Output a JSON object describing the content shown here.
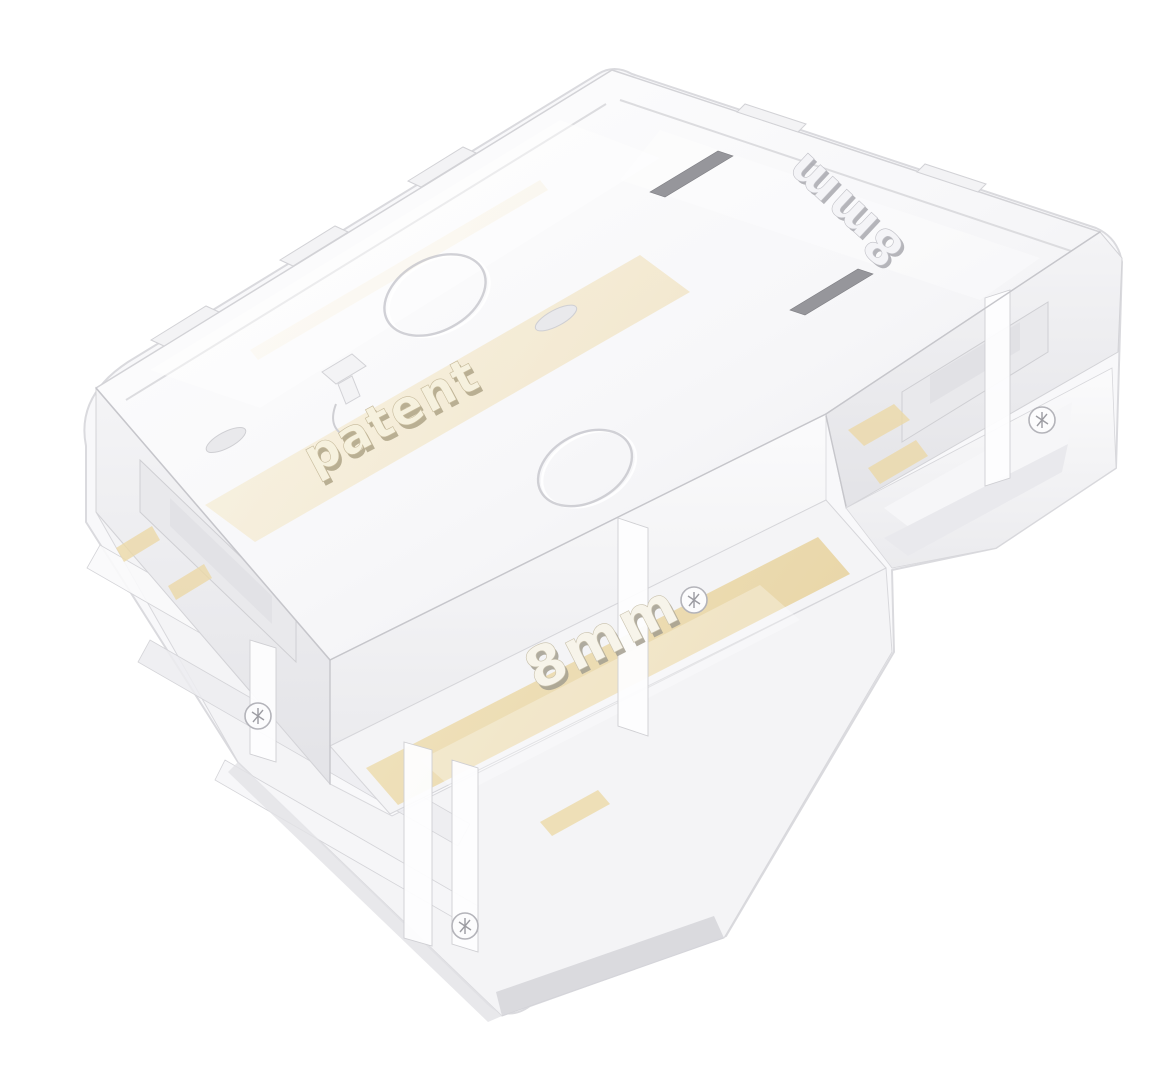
{
  "page": {
    "background_color": "#ffffff"
  },
  "connector": {
    "markings": {
      "patent": "patent",
      "size_right_arm": "8mm",
      "size_front_channel": "8mm"
    },
    "colors": {
      "plastic_base": "#f8f8fa",
      "plastic_shadow": "#e7e7eb",
      "edge_line": "#c6c6cb",
      "slot_gray": "#96969b",
      "gold": "#ecd9a8",
      "gold_light": "#f6edd4",
      "metal_clip": "#b4b4ba"
    }
  }
}
